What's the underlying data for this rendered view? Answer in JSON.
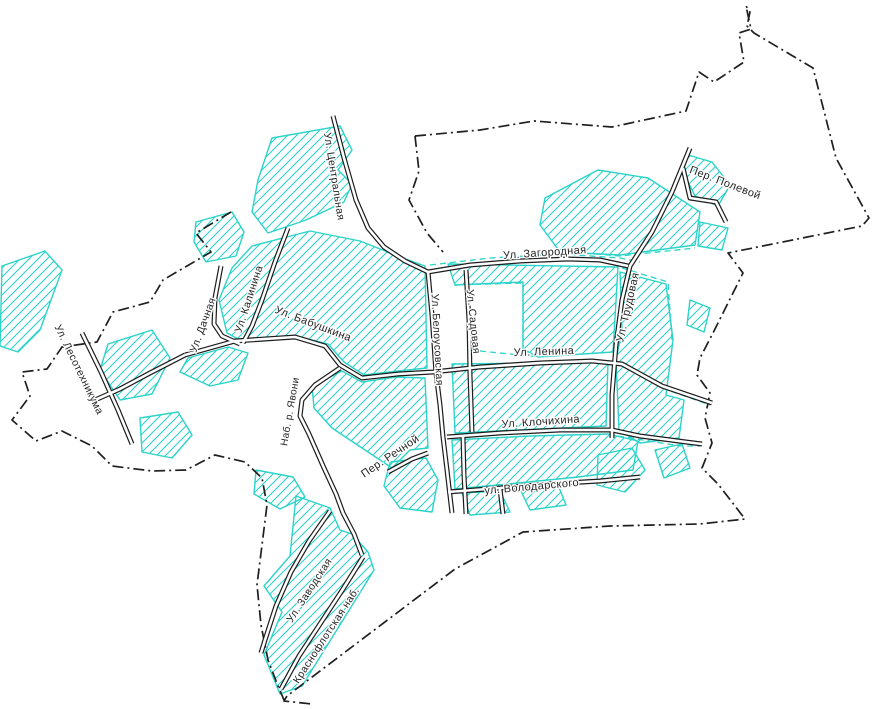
{
  "map": {
    "kind": "town-street-plan",
    "background": "#ffffff",
    "colors": {
      "boundary": "#1f1f1f",
      "road_casing": "#1c1c1c",
      "road_fill": "#ffffff",
      "hatch": "#2bd3c9",
      "hatch_outline": "#2bd3c9",
      "label": "#252525",
      "label_halo": "#ffffff"
    },
    "boundary_paths": [
      "M415,136 L480,130 L534,121 L612,127 L686,111 L699,72 L714,82 L744,62 L739,33 L751,29 L746,6 L750,12 L747,26 L754,33 L813,68 L836,158 L869,218 L862,226 L728,253 L743,273 L714,331 L700,358 L697,375 L710,393 L705,418 L712,443 L702,468 L718,484 L745,519 L700,524 L610,526 L523,532 L455,569 L287,696 L284,701 L312,704",
      "M415,136 L419,171 L409,200 L427,233 L443,252",
      "M231,212 L196,233 L211,252 L163,280 L150,302 L113,312 L97,342 L62,347 L47,369 L22,372 L30,396 L12,420 L36,441 L62,431 L92,446 L112,466 L152,471 L186,470 L215,455 L245,462 L262,478 L267,505 L262,545 L257,585 L261,625 L268,660 L278,686 L284,700"
    ],
    "dashed_cyan_paths": [
      "M430,265 L490,258 L560,254 L620,258 L640,262",
      "M545,250 L620,256 L695,248",
      "M622,268 L668,282 L672,340",
      "M618,436 L680,446 L700,446",
      "M455,285 L523,283 L523,349",
      "M470,350 L540,357",
      "M662,388 L710,405"
    ],
    "hatch_areas": [
      {
        "name": "topleft-block",
        "points": "272,138 340,126 352,150 338,170 352,184 344,202 306,220 268,233 252,212 258,180 266,156"
      },
      {
        "name": "dachnaya-north",
        "points": "196,222 232,212 244,232 236,256 206,262 194,242"
      },
      {
        "name": "far-west",
        "points": "2,266 45,251 62,270 40,330 18,352 0,346"
      },
      {
        "name": "west-mid",
        "points": "108,344 152,330 170,358 152,394 120,400 100,370"
      },
      {
        "name": "west-small",
        "points": "140,418 178,412 192,435 172,458 142,452"
      },
      {
        "name": "central-big",
        "points": "252,246 310,231 360,241 400,257 425,266 427,368 398,371 364,375 344,362 328,344 296,336 242,341 227,333 219,300 232,268"
      },
      {
        "name": "babushkina-south-west",
        "points": "188,358 228,347 248,353 238,380 210,386 180,372"
      },
      {
        "name": "central-south",
        "points": "312,386 342,371 362,382 396,377 425,378 428,448 410,450 392,468 362,448 332,428 314,408"
      },
      {
        "name": "zagorodnaya-block",
        "points": "448,264 618,267 613,352 538,357 523,349 523,282 455,285"
      },
      {
        "name": "northeast-block",
        "points": "545,198 598,170 648,178 700,212 695,245 620,255 560,252 540,225"
      },
      {
        "name": "polevoy-north",
        "points": "688,155 712,162 730,185 718,206 695,196 683,172"
      },
      {
        "name": "polevoy-small",
        "points": "700,222 728,228 722,250 698,246"
      },
      {
        "name": "lenina-klochikhina-block",
        "points": "452,364 608,362 606,426 540,429 455,433"
      },
      {
        "name": "east-of-trudovaya",
        "points": "620,272 666,284 673,340 666,395 684,400 679,438 640,443 619,430 616,360 622,330"
      },
      {
        "name": "klochikhina-volodarskogo-block",
        "points": "452,440 530,436 608,434 638,441 633,470 578,477 518,483 455,489"
      },
      {
        "name": "volodarskogo-south-1",
        "points": "462,493 500,491 510,512 470,515"
      },
      {
        "name": "volodarskogo-south-2",
        "points": "520,489 558,485 566,505 530,510"
      },
      {
        "name": "southeast-1",
        "points": "598,455 632,448 645,470 625,492 597,485"
      },
      {
        "name": "southeast-2",
        "points": "655,450 682,444 690,468 664,478"
      },
      {
        "name": "peninsula",
        "points": "296,496 330,508 340,530 352,534 368,552 374,570 302,686 280,694 264,655 282,612 264,586 290,556"
      },
      {
        "name": "peninsula-neck",
        "points": "256,470 293,477 305,497 280,509 254,494"
      },
      {
        "name": "belousovskaya-south",
        "points": "390,462 426,458 438,480 432,512 400,508 384,486"
      },
      {
        "name": "east-bits",
        "points": "690,300 710,308 704,332 687,325"
      }
    ],
    "roads": [
      {
        "name": "tsentralnaya",
        "path": "M333,116 L344,158 L356,200 L368,228 L384,247 L405,261 L428,272"
      },
      {
        "name": "zagorodnaya",
        "path": "M428,272 L470,265 L520,261 L568,259 L600,260 L628,266"
      },
      {
        "name": "trudovaya",
        "path": "M690,148 L672,192 L652,232 L630,266 L622,300 L616,345 L612,395 L612,438"
      },
      {
        "name": "polevoy",
        "path": "M683,168 L690,198 L716,202 L726,222"
      },
      {
        "name": "babushkina-lenina",
        "path": "M185,355 L235,341 L295,337 L325,346 L340,365 L362,378 L398,374 L433,372 L480,367 L540,363 L592,361 L622,364 L662,386 L712,403"
      },
      {
        "name": "klochikhina",
        "path": "M447,437 L500,433 L560,430 L612,430 L640,436 L686,442 L702,444"
      },
      {
        "name": "volodarskogo",
        "path": "M448,492 L500,488 L548,484 L600,481 L640,477"
      },
      {
        "name": "belousovskaya",
        "path": "M428,272 L432,315 L436,373 L440,405 L443,437 L447,470 L452,513"
      },
      {
        "name": "sadovaya",
        "path": "M466,270 L469,320 L470,375 L472,432"
      },
      {
        "name": "sadovaya-south",
        "path": "M463,437 L464,475 L466,514"
      },
      {
        "name": "kalinina",
        "path": "M288,228 L275,262 L262,300 L252,326 L243,343"
      },
      {
        "name": "dachnaya",
        "path": "M221,266 L215,298 L214,324 L222,336 L240,344"
      },
      {
        "name": "west-extension",
        "path": "M185,355 L150,373 L120,389 L95,400"
      },
      {
        "name": "lesotekhnikuma",
        "path": "M82,333 L101,372 L118,410 L132,444"
      },
      {
        "name": "naberezhnaya",
        "path": "M340,368 L315,385 L302,400 L300,416 L309,434 L324,468 L336,494 L343,513"
      },
      {
        "name": "rechnoy",
        "path": "M388,472 L412,459 L428,453"
      },
      {
        "name": "zavodskaya",
        "path": "M330,511 L309,541 L291,572 L276,606 L265,640 L261,653"
      },
      {
        "name": "krasnoflotskaya",
        "path": "M363,557 L343,589 L320,624 L299,656 L281,689"
      },
      {
        "name": "peninsula-connector",
        "path": "M343,513 L354,534 L362,555"
      },
      {
        "name": "south-stub",
        "path": "M500,489 L503,514"
      }
    ],
    "labels": [
      {
        "name": "tsentralnaya",
        "text": "Ул. Центральная",
        "x": 331,
        "y": 177,
        "rotate": 81,
        "size": 10.5
      },
      {
        "name": "zagorodnaya",
        "text": "Ул. Загородная",
        "x": 545,
        "y": 256,
        "rotate": -4,
        "size": 11
      },
      {
        "name": "polevoy",
        "text": "Пер. Полевой",
        "x": 724,
        "y": 186,
        "rotate": 21,
        "size": 11
      },
      {
        "name": "trudovaya",
        "text": "Ул. Трудовая",
        "x": 631,
        "y": 308,
        "rotate": -77,
        "size": 11
      },
      {
        "name": "lenina",
        "text": "Ул. Ленина",
        "x": 544,
        "y": 355,
        "rotate": -2,
        "size": 11
      },
      {
        "name": "sadovaya",
        "text": "Ул. Садовая",
        "x": 470,
        "y": 322,
        "rotate": 84,
        "size": 10.5
      },
      {
        "name": "belousovskaya",
        "text": "Ул. Белоусовская",
        "x": 434,
        "y": 340,
        "rotate": 87,
        "size": 10.5
      },
      {
        "name": "babushkina",
        "text": "Ул. Бабушкина",
        "x": 312,
        "y": 327,
        "rotate": 21,
        "size": 11
      },
      {
        "name": "kalinina",
        "text": "Ул. Калинина",
        "x": 252,
        "y": 300,
        "rotate": -72,
        "size": 10.5
      },
      {
        "name": "dachnaya",
        "text": "Ул. Дачная",
        "x": 206,
        "y": 326,
        "rotate": -70,
        "size": 10.5
      },
      {
        "name": "lesotekhnikuma",
        "text": "Ул. Лесотехникума",
        "x": 76,
        "y": 371,
        "rotate": 64,
        "size": 10.5
      },
      {
        "name": "naberezhnaya",
        "text": "Наб. р. Явони",
        "x": 293,
        "y": 412,
        "rotate": -80,
        "size": 10
      },
      {
        "name": "rechnoy",
        "text": "Пер. Речной",
        "x": 392,
        "y": 459,
        "rotate": -34,
        "size": 11
      },
      {
        "name": "klochikhina",
        "text": "Ул. Клочихина",
        "x": 541,
        "y": 425,
        "rotate": -4,
        "size": 11
      },
      {
        "name": "volodarskogo",
        "text": "ул. Володарского",
        "x": 532,
        "y": 490,
        "rotate": -5,
        "size": 11
      },
      {
        "name": "zavodskaya",
        "text": "Ул. Заводская",
        "x": 312,
        "y": 592,
        "rotate": -57,
        "size": 10.5
      },
      {
        "name": "krasnoflotskaya",
        "text": "Краснофлотская наб.",
        "x": 329,
        "y": 637,
        "rotate": -57,
        "size": 10.5
      }
    ]
  }
}
